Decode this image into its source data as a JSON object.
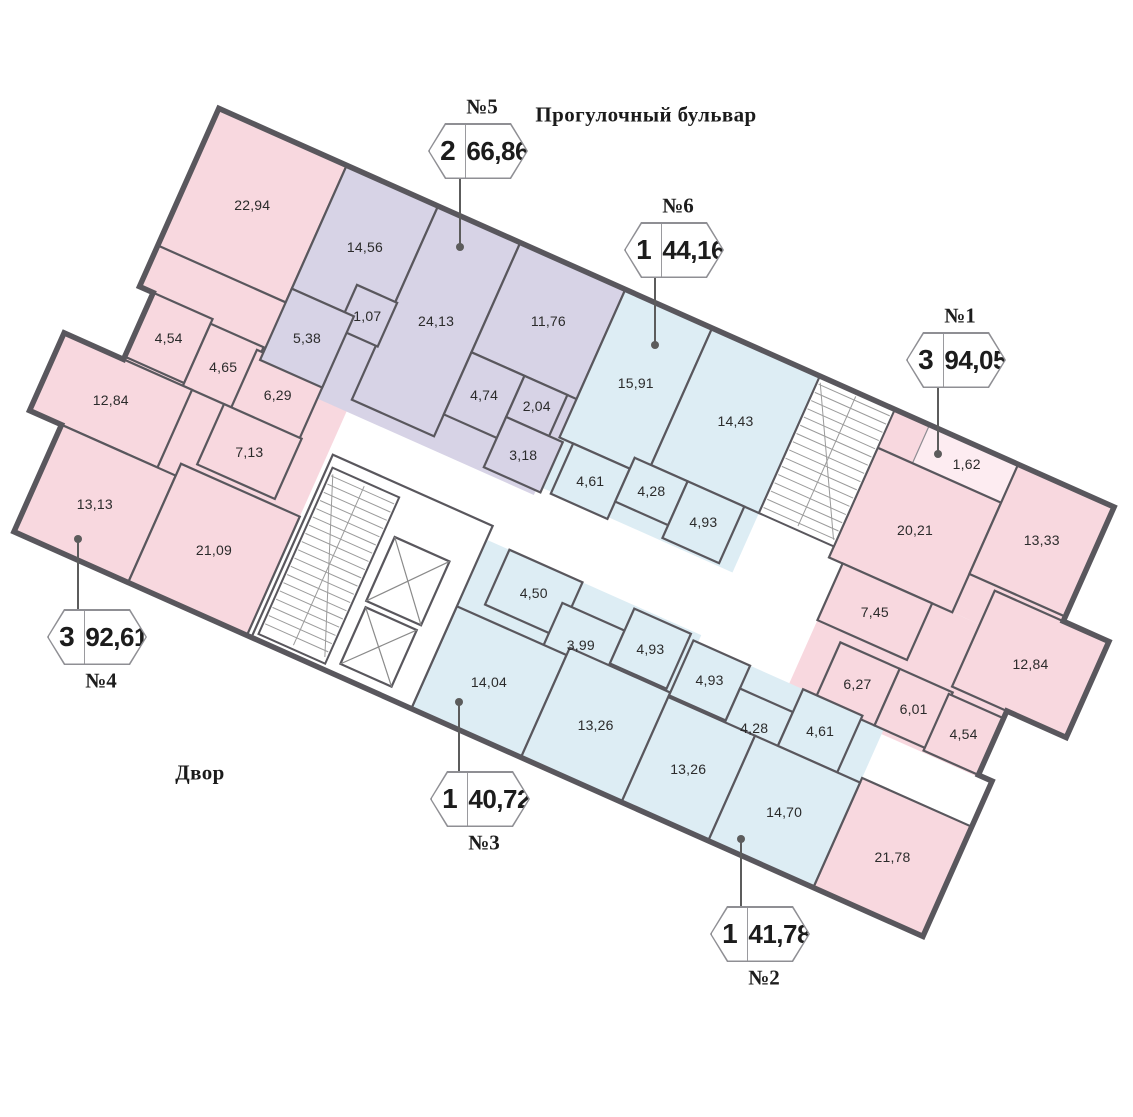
{
  "labels": {
    "street": "Прогулочный бульвар",
    "courtyard": "Двор"
  },
  "colors": {
    "pink": "#f8d8df",
    "purple": "#d7d3e6",
    "blue": "#ddedf4",
    "loggia": "#fdecf1",
    "wall": "#59575d",
    "stair_line": "#9b9b9b",
    "pointer": "#5c5c5c"
  },
  "apartment_colors": {
    "1": "pink",
    "2": "blue",
    "3": "blue",
    "4": "pink",
    "5": "purple",
    "6": "blue"
  },
  "apartments": [
    {
      "id": "1",
      "label": "№1",
      "rooms_count": "3",
      "total_area": "94,05",
      "cx": 956,
      "cy": 360,
      "label_side": "above",
      "line_x": 937,
      "line_y1": 388,
      "line_y2": 454,
      "dot_y": 454
    },
    {
      "id": "2",
      "label": "№2",
      "rooms_count": "1",
      "total_area": "41,78",
      "cx": 760,
      "cy": 934,
      "label_side": "below",
      "line_x": 740,
      "line_y1": 839,
      "line_y2": 908,
      "dot_y": 839
    },
    {
      "id": "3",
      "label": "№3",
      "rooms_count": "1",
      "total_area": "40,72",
      "cx": 480,
      "cy": 799,
      "label_side": "below",
      "line_x": 458,
      "line_y1": 702,
      "line_y2": 773,
      "dot_y": 702
    },
    {
      "id": "4",
      "label": "№4",
      "rooms_count": "3",
      "total_area": "92,61",
      "cx": 97,
      "cy": 637,
      "label_side": "below",
      "line_x": 77,
      "line_y1": 539,
      "line_y2": 611,
      "dot_y": 539
    },
    {
      "id": "5",
      "label": "№5",
      "rooms_count": "2",
      "total_area": "66,86",
      "cx": 478,
      "cy": 151,
      "label_side": "above",
      "line_x": 459,
      "line_y1": 179,
      "line_y2": 247,
      "dot_y": 247
    },
    {
      "id": "6",
      "label": "№6",
      "rooms_count": "1",
      "total_area": "44,16",
      "cx": 674,
      "cy": 250,
      "label_side": "above",
      "line_x": 654,
      "line_y1": 278,
      "line_y2": 345,
      "dot_y": 345
    }
  ],
  "geometry": {
    "x": 164,
    "y": 84,
    "angle": 24,
    "footprint": [
      [
        60,
        0
      ],
      [
        1040,
        0
      ],
      [
        1040,
        125
      ],
      [
        1090,
        125
      ],
      [
        1090,
        230
      ],
      [
        1025,
        230
      ],
      [
        1025,
        300
      ],
      [
        1040,
        300
      ],
      [
        1040,
        470
      ],
      [
        45,
        470
      ],
      [
        45,
        353
      ],
      [
        10,
        353
      ],
      [
        10,
        268
      ],
      [
        75,
        268
      ],
      [
        75,
        195
      ],
      [
        60,
        195
      ]
    ],
    "regions": [
      {
        "apt": "4",
        "rect": [
          60,
          0,
          140,
          195
        ]
      },
      {
        "apt": "4",
        "rect": [
          10,
          150,
          290,
          320
        ]
      },
      {
        "apt": "5",
        "rect": [
          200,
          0,
          305,
          225
        ]
      },
      {
        "apt": "6",
        "rect": [
          505,
          0,
          213,
          215
        ]
      },
      {
        "apt": "1",
        "rect": [
          800,
          0,
          240,
          162
        ]
      },
      {
        "apt": "1",
        "rect": [
          815,
          162,
          210,
          140
        ]
      },
      {
        "apt": "1",
        "rect": [
          965,
          125,
          125,
          105
        ]
      },
      {
        "apt": "1",
        "rect": [
          920,
          350,
          120,
          120
        ]
      },
      {
        "apt": "3",
        "rect": [
          480,
          285,
          235,
          185
        ]
      },
      {
        "apt": "2",
        "rect": [
          700,
          293,
          220,
          177
        ]
      }
    ],
    "rooms": [
      {
        "apt": "4",
        "area": "22,94",
        "rect": [
          60,
          0,
          140,
          150
        ]
      },
      {
        "apt": "4",
        "area": "4,54",
        "rect": [
          75,
          195,
          65,
          70
        ]
      },
      {
        "apt": "4",
        "area": "4,65",
        "rect": [
          140,
          200,
          58,
          68
        ]
      },
      {
        "apt": "4",
        "area": "6,29",
        "rect": [
          193,
          205,
          75,
          66
        ]
      },
      {
        "apt": "4",
        "area": "12,84",
        "rect": [
          10,
          268,
          140,
          85
        ]
      },
      {
        "apt": "4",
        "area": "7,13",
        "rect": [
          185,
          268,
          85,
          66
        ]
      },
      {
        "apt": "4",
        "area": "13,13",
        "rect": [
          45,
          353,
          125,
          117
        ]
      },
      {
        "apt": "4",
        "area": "21,09",
        "rect": [
          170,
          340,
          130,
          130
        ]
      },
      {
        "apt": "5",
        "area": "14,56",
        "rect": [
          200,
          0,
          100,
          135
        ]
      },
      {
        "apt": "5",
        "area": "24,13",
        "rect": [
          300,
          0,
          90,
          212
        ]
      },
      {
        "apt": "5",
        "area": "11,76",
        "rect": [
          390,
          0,
          115,
          120
        ]
      },
      {
        "apt": "5",
        "area": "1,07",
        "rect": [
          258,
          105,
          44,
          48
        ]
      },
      {
        "apt": "5",
        "area": "5,38",
        "rect": [
          200,
          135,
          68,
          78
        ]
      },
      {
        "apt": "5",
        "area": "4,74",
        "rect": [
          390,
          120,
          58,
          68
        ]
      },
      {
        "apt": "5",
        "area": "2,04",
        "rect": [
          448,
          120,
          47,
          45
        ]
      },
      {
        "apt": "5",
        "area": "3,18",
        "rect": [
          448,
          165,
          62,
          55
        ]
      },
      {
        "apt": "6",
        "area": "15,91",
        "rect": [
          505,
          0,
          95,
          162
        ]
      },
      {
        "apt": "6",
        "area": "14,43",
        "rect": [
          600,
          0,
          118,
          150
        ]
      },
      {
        "apt": "6",
        "area": "4,61",
        "rect": [
          520,
          162,
          62,
          55
        ]
      },
      {
        "apt": "6",
        "area": "4,28",
        "rect": [
          582,
          150,
          58,
          48
        ]
      },
      {
        "apt": "6",
        "area": "4,93",
        "rect": [
          640,
          150,
          62,
          62
        ]
      },
      {
        "apt": "1",
        "area": "1,62",
        "rect": [
          838,
          0,
          100,
          42
        ],
        "thin": true
      },
      {
        "apt": "1",
        "area": "20,21",
        "rect": [
          800,
          42,
          135,
          120
        ]
      },
      {
        "apt": "1",
        "area": "13,33",
        "rect": [
          935,
          0,
          105,
          120
        ]
      },
      {
        "apt": "1",
        "area": "7,45",
        "rect": [
          815,
          162,
          98,
          62
        ]
      },
      {
        "apt": "1",
        "area": "12,84",
        "rect": [
          965,
          125,
          125,
          105
        ]
      },
      {
        "apt": "1",
        "area": "6,27",
        "rect": [
          845,
          235,
          65,
          62
        ]
      },
      {
        "apt": "1",
        "area": "6,01",
        "rect": [
          910,
          235,
          58,
          62
        ]
      },
      {
        "apt": "1",
        "area": "4,54",
        "rect": [
          965,
          238,
          60,
          62
        ]
      },
      {
        "apt": "1",
        "area": "21,78",
        "rect": [
          920,
          350,
          120,
          120
        ]
      },
      {
        "apt": "3",
        "area": "4,50",
        "rect": [
          505,
          285,
          80,
          60
        ]
      },
      {
        "apt": "3",
        "area": "3,99",
        "rect": [
          575,
          312,
          68,
          62
        ]
      },
      {
        "apt": "3",
        "area": "4,93",
        "rect": [
          643,
          288,
          62,
          60
        ]
      },
      {
        "apt": "3",
        "area": "14,04",
        "rect": [
          480,
          358,
          120,
          112
        ]
      },
      {
        "apt": "3",
        "area": "13,26",
        "rect": [
          600,
          350,
          110,
          120
        ]
      },
      {
        "apt": "2",
        "area": "4,93",
        "rect": [
          710,
          293,
          62,
          60
        ]
      },
      {
        "apt": "2",
        "area": "4,28",
        "rect": [
          772,
          318,
          58,
          60
        ]
      },
      {
        "apt": "2",
        "area": "4,61",
        "rect": [
          830,
          293,
          65,
          62
        ]
      },
      {
        "apt": "2",
        "area": "13,26",
        "rect": [
          710,
          355,
          95,
          115
        ]
      },
      {
        "apt": "2",
        "area": "14,70",
        "rect": [
          805,
          355,
          115,
          115
        ]
      }
    ],
    "cores": [
      {
        "type": "box",
        "rect": [
          305,
          270,
          175,
          200
        ]
      },
      {
        "type": "stairs",
        "rect": [
          718,
          0,
          82,
          150
        ]
      },
      {
        "type": "stairs",
        "rect": [
          310,
          282,
          73,
          182
        ]
      },
      {
        "type": "elevator",
        "rect": [
          395,
          320,
          60,
          70
        ]
      },
      {
        "type": "elevator",
        "rect": [
          397,
          396,
          56,
          62
        ]
      }
    ]
  }
}
